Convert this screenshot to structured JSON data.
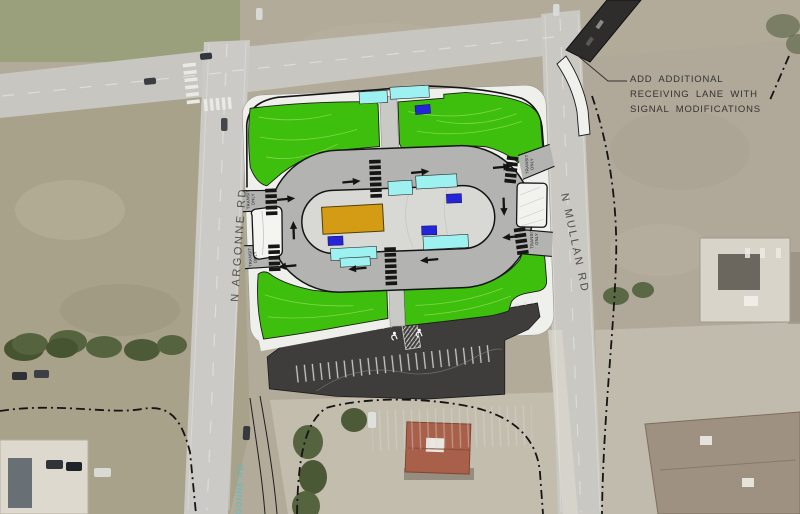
{
  "annotation": {
    "line1": "ADD ADDITIONAL",
    "line2": "RECEIVING LANE WITH",
    "line3": "SIGNAL MODIFICATIONS"
  },
  "road_labels": {
    "argonne": "N ARGONNE RD",
    "mullan": "N MULLAN RD",
    "argonne_gis": "ARGONNE RD"
  },
  "lane_markings": {
    "transit": "TRANSIT",
    "only": "ONLY"
  },
  "colors": {
    "landscape_green": "#3ebe0d",
    "loop_road_gray": "#b3b3b1",
    "island_gray": "#d8d8d4",
    "building_orange": "#d49c15",
    "shelter_cyan": "#9df2f1",
    "marker_blue": "#2424d8",
    "parking_charcoal": "#3e3d3c",
    "sidewalk_white": "#efefeb",
    "new_lane_dark": "#2e2d2c"
  }
}
